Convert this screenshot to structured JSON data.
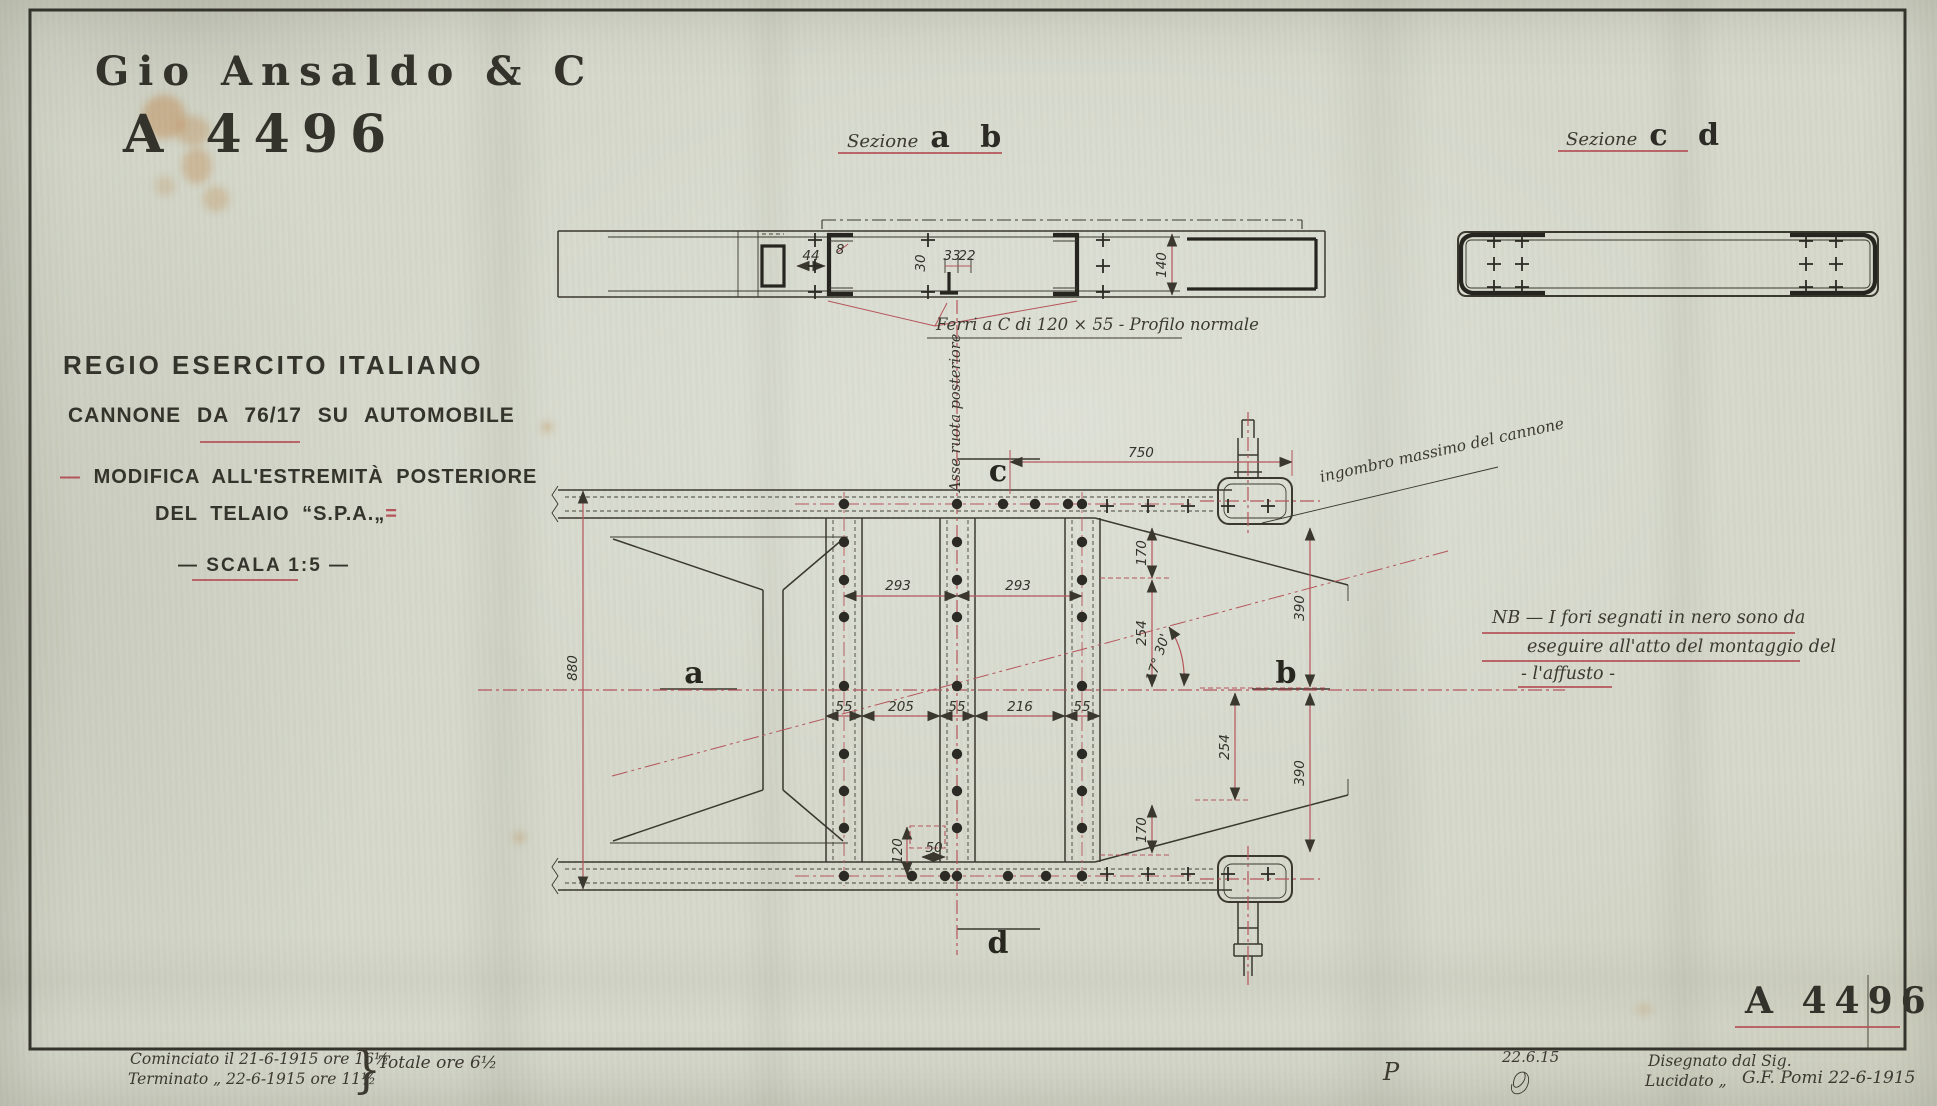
{
  "header": {
    "company": "Gio Ansaldo & C",
    "drawing_number": "A 4496"
  },
  "title_block": {
    "army": "REGIO ESERCITO ITALIANO",
    "subject": "CANNONE DA 76/17 SU AUTOMOBILE",
    "mod_dash": "—",
    "mod_line1": "MODIFICA ALL'ESTREMITÀ POSTERIORE",
    "mod_line2": "DEL TELAIO “S.P.A.„",
    "mod_suffix": "=",
    "scale": "— SCALA 1:5 —"
  },
  "sections": {
    "ab": {
      "prefix": "Sezione",
      "letters": "a b"
    },
    "cd": {
      "prefix": "Sezione",
      "letters": "c d"
    }
  },
  "annotations": {
    "ferri": "Ferri a C di 120 × 55 - Profilo normale",
    "asse": "Asse ruota posteriore",
    "ingombro": "ingombro massimo del cannone",
    "nb_line1": "NB — I fori segnati in nero sono da",
    "nb_line2": "eseguire all'atto del montaggio del",
    "nb_line3": "- l'affusto -"
  },
  "footer": {
    "started": "Cominciato il 21-6-1915 ore 16½",
    "finished": "Terminato „ 22-6-1915 ore 11½",
    "brace": "}",
    "total": "Totale ore 6½",
    "monogram": "P",
    "date_sig": "22.6.15",
    "drawn_label": "Disegnato dal Sig.",
    "traced_label": "Lucidato „",
    "signature": "G.F. Pomi 22-6-1915",
    "drawing_number": "A 4496"
  },
  "colors": {
    "paper": "#d5d8cb",
    "ink": "#34332c",
    "red": "#b5555b",
    "stain": "#c08a4f"
  },
  "dims": [
    {
      "t": "750",
      "x": 1141,
      "y": 457,
      "r": 0
    },
    {
      "t": "880",
      "x": 577,
      "y": 668,
      "r": -90
    },
    {
      "t": "293",
      "x": 898,
      "y": 590,
      "r": 0
    },
    {
      "t": "293",
      "x": 1018,
      "y": 590,
      "r": 0
    },
    {
      "t": "55",
      "x": 844,
      "y": 711,
      "r": 0
    },
    {
      "t": "205",
      "x": 901,
      "y": 711,
      "r": 0
    },
    {
      "t": "55",
      "x": 957,
      "y": 711,
      "r": 0
    },
    {
      "t": "216",
      "x": 1020,
      "y": 711,
      "r": 0
    },
    {
      "t": "55",
      "x": 1082,
      "y": 711,
      "r": 0
    },
    {
      "t": "170",
      "x": 1146,
      "y": 553,
      "r": -90
    },
    {
      "t": "254",
      "x": 1146,
      "y": 633,
      "r": -90
    },
    {
      "t": "390",
      "x": 1304,
      "y": 608,
      "r": -90
    },
    {
      "t": "254",
      "x": 1229,
      "y": 747,
      "r": -90
    },
    {
      "t": "390",
      "x": 1304,
      "y": 773,
      "r": -90
    },
    {
      "t": "170",
      "x": 1146,
      "y": 830,
      "r": -90
    },
    {
      "t": "120",
      "x": 902,
      "y": 851,
      "r": -90
    },
    {
      "t": "50",
      "x": 934,
      "y": 852,
      "r": 0
    },
    {
      "t": "140",
      "x": 1166,
      "y": 265,
      "r": -90
    },
    {
      "t": "44",
      "x": 811,
      "y": 260,
      "r": 0
    },
    {
      "t": "8",
      "x": 840,
      "y": 254,
      "r": 0
    },
    {
      "t": "30",
      "x": 925,
      "y": 263,
      "r": -90
    },
    {
      "t": "33",
      "x": 952,
      "y": 260,
      "r": 0
    },
    {
      "t": "22",
      "x": 967,
      "y": 260,
      "r": 0
    },
    {
      "t": "17° 30'",
      "x": 1162,
      "y": 659,
      "r": -72
    },
    {
      "t": "a",
      "x": 694,
      "y": 683,
      "r": 0,
      "cls": "letter"
    },
    {
      "t": "b",
      "x": 1286,
      "y": 683,
      "r": 0,
      "cls": "letter"
    },
    {
      "t": "c",
      "x": 998,
      "y": 481,
      "r": 0,
      "cls": "letter"
    },
    {
      "t": "d",
      "x": 998,
      "y": 953,
      "r": 0,
      "cls": "letter"
    }
  ]
}
